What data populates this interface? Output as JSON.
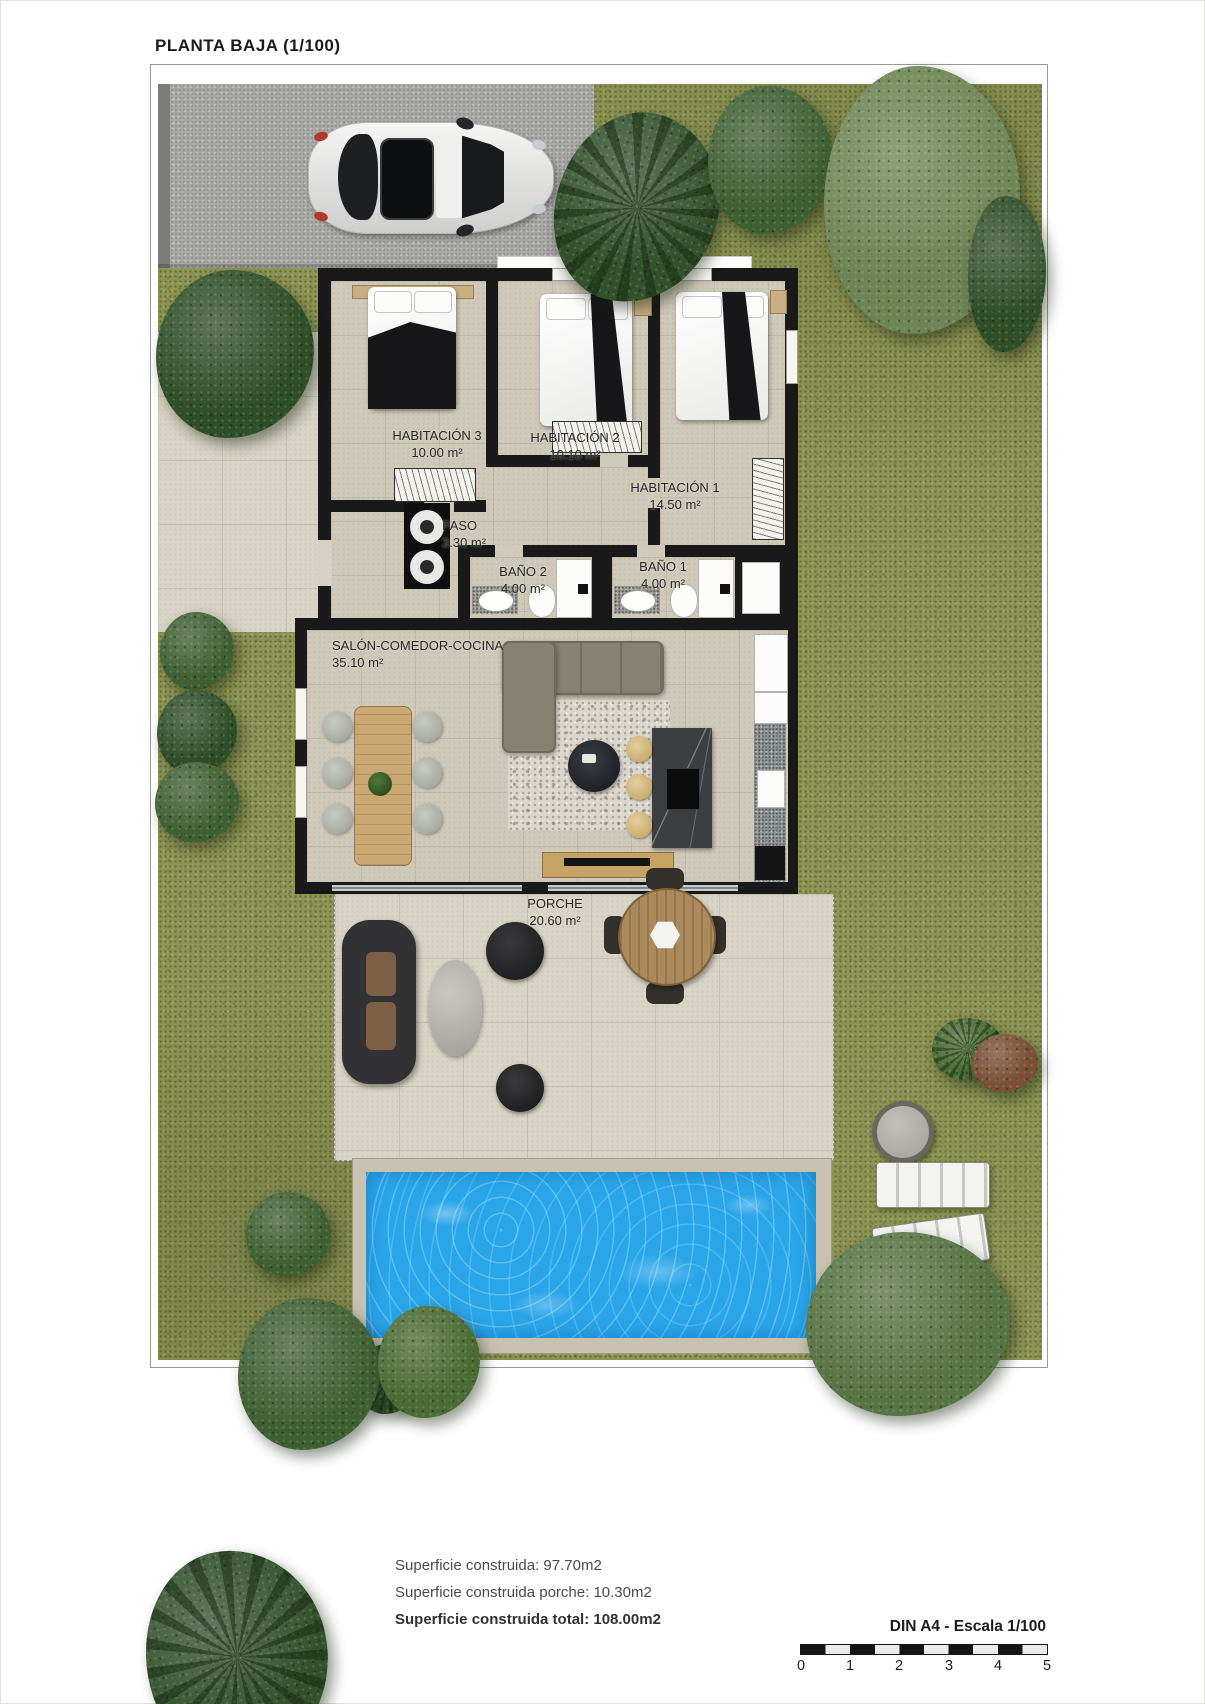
{
  "title": "PLANTA BAJA (1/100)",
  "rooms": [
    {
      "name": "HABITACIÓN 3",
      "area": "10.00 m²"
    },
    {
      "name": "HABITACIÓN 2",
      "area": "10.10 m²"
    },
    {
      "name": "HABITACIÓN 1",
      "area": "14.50 m²"
    },
    {
      "name": "PASO",
      "area": "3.30 m²"
    },
    {
      "name": "BAÑO 2",
      "area": "4.00 m²"
    },
    {
      "name": "BAÑO 1",
      "area": "4.00 m²"
    },
    {
      "name": "SALÓN-COMEDOR-COCINA",
      "area": "35.10 m²"
    },
    {
      "name": "PORCHE",
      "area": "20.60 m²"
    }
  ],
  "summary": {
    "construida": "Superficie construida: 97.70m2",
    "porche": "Superficie construida porche: 10.30m2",
    "total": "Superficie construida total: 108.00m2"
  },
  "scalebar": {
    "label": "DIN A4 - Escala 1/100",
    "ticks": [
      "0",
      "1",
      "2",
      "3",
      "4",
      "5"
    ]
  },
  "colors": {
    "grass": "#8d9455",
    "driveway": "#a9a9a7",
    "wall": "#191919",
    "floor": "#cfc9ba",
    "deck": "#d9d4c5",
    "pool_water": "#2aa5e8",
    "pool_border": "#c8c1af",
    "foliage": "#3c5c30"
  }
}
